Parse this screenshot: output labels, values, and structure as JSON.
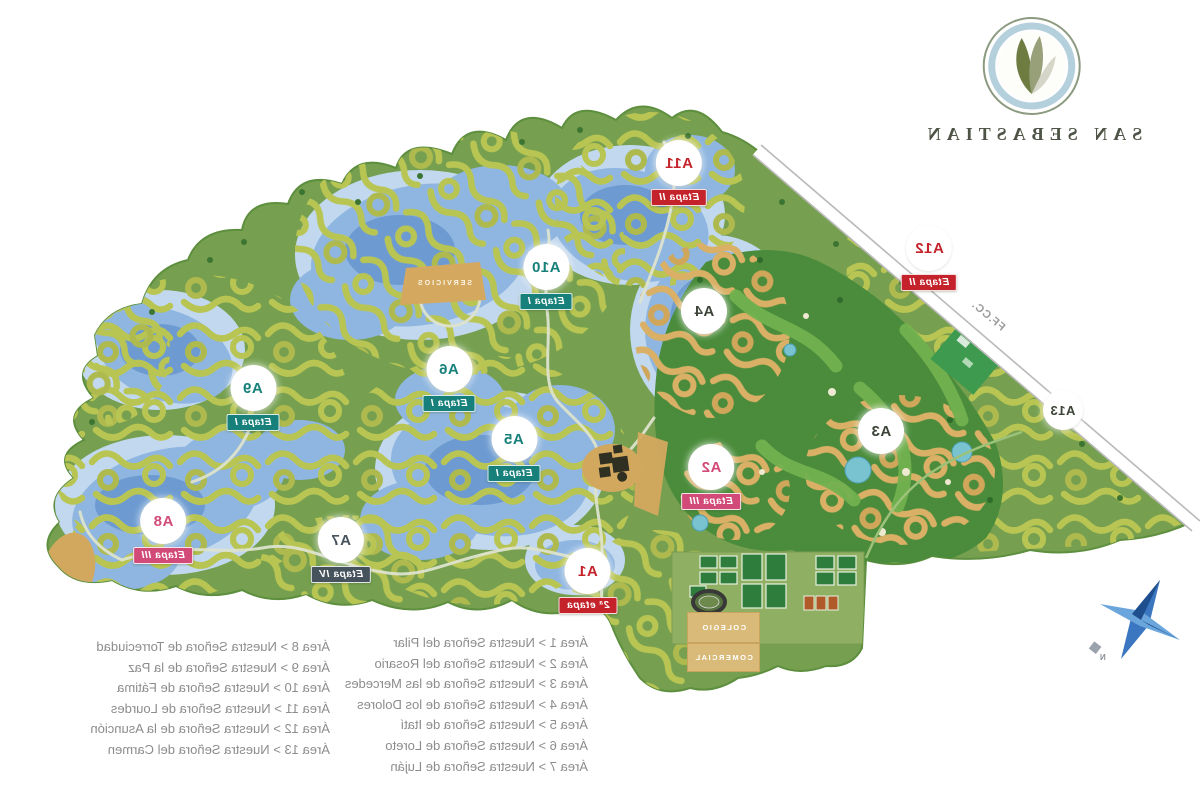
{
  "logo": {
    "title": "SAN SEBASTIAN"
  },
  "railway": {
    "label": "FF.CC."
  },
  "compass": {
    "north_label": "N"
  },
  "areas": {
    "a1": {
      "code": "A1",
      "stage": "2ª etapa"
    },
    "a2": {
      "code": "A2",
      "stage": "Etapa III"
    },
    "a3": {
      "code": "A3"
    },
    "a4": {
      "code": "A4"
    },
    "a5": {
      "code": "A5",
      "stage": "Etapa I"
    },
    "a6": {
      "code": "A6",
      "stage": "Etapa I"
    },
    "a7": {
      "code": "A7",
      "stage": "Etapa IV"
    },
    "a8": {
      "code": "A8",
      "stage": "Etapa III"
    },
    "a9": {
      "code": "A9",
      "stage": "Etapa I"
    },
    "a10": {
      "code": "A10",
      "stage": "Etapa I"
    },
    "a11": {
      "code": "A11",
      "stage": "Etapa II"
    },
    "a12": {
      "code": "A12",
      "stage": "Etapa II"
    },
    "a13": {
      "code": "A13"
    }
  },
  "facilities": {
    "school": "COLEGIO",
    "commercial": "COMERCIAL",
    "services": "SERVICIOS"
  },
  "legend": {
    "column_a": [
      "Área 8 > Nuestra Señora de Torreciudad",
      "Área 9 > Nuestra Señora de la Paz",
      "Área 10 > Nuestra Señora de Fátima",
      "Área 11 > Nuestra Señora de Lourdes",
      "Área 12 > Nuestra Señora de la Asunción",
      "Área 13 > Nuestra Señora del Carmen"
    ],
    "column_b": [
      "Área 1 > Nuestra Señora del Pilar",
      "Área 2 > Nuestra Señora del Rosario",
      "Área 3 > Nuestra Señora de las Mercedes",
      "Área 4 > Nuestra Señora de los Dolores",
      "Área 5 > Nuestra Señora de Itatí",
      "Área 6 > Nuestra Señora de Loreto",
      "Área 7 > Nuestra Señora de Luján"
    ]
  },
  "colors": {
    "etapa_1": "#17807a",
    "etapa_2": "#c4232b",
    "etapa_3": "#d24a78",
    "etapa_4": "#46525c",
    "land": "#76a050",
    "golf": "#4a8c3b",
    "water": "#8fb6e0",
    "sand": "#d4a95f"
  }
}
